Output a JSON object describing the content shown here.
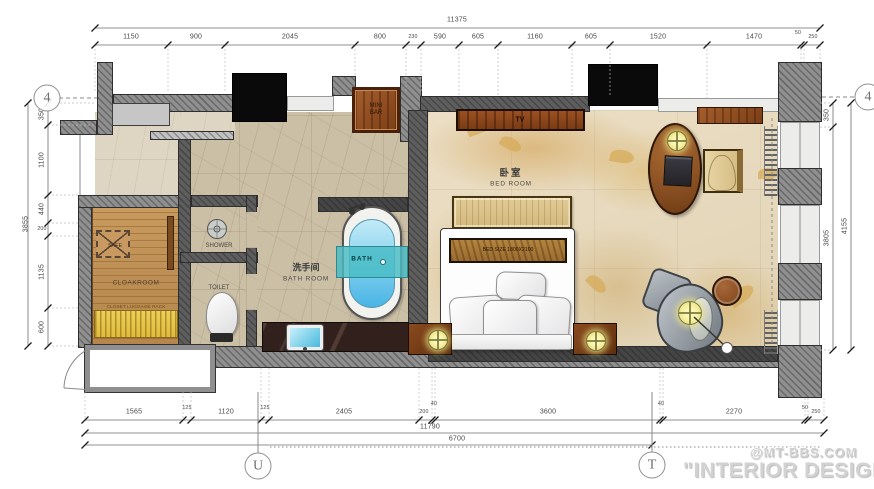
{
  "plan": {
    "markers": {
      "left": "4",
      "right": "4",
      "bottom_left": "U",
      "bottom_right": "T"
    },
    "rooms": {
      "bedroom_cn": "卧室",
      "bedroom_en": "BED ROOM",
      "bathroom_cn": "洗手间",
      "bathroom_en": "BATH ROOM",
      "cloakroom": "CLOAKROOM",
      "closet_rack": "CLOSET LUGGAGE RACK",
      "safe": "SAFE",
      "shower": "SHOWER",
      "toilet": "TOILET",
      "bath": "BATH",
      "minibar": "MINI BAR",
      "tv": "TV",
      "bed_size": "BED SIZE 1800X2100"
    }
  },
  "dims": {
    "top": {
      "total": "11375",
      "segments": [
        "1150",
        "900",
        "2045",
        "800",
        "230",
        "590",
        "605",
        "1160",
        "605",
        "1520",
        "1470",
        "50",
        "250"
      ]
    },
    "left": {
      "total": "3855",
      "segments": [
        "350",
        "1100",
        "440",
        "200",
        "1135",
        "600"
      ]
    },
    "right": {
      "inner": "350",
      "middle": "3805",
      "outer": "4155"
    },
    "bottom": {
      "segments": [
        "1565",
        "125",
        "1120",
        "125",
        "2405",
        "200",
        "40",
        "3600",
        "40",
        "2270",
        "50",
        "250"
      ],
      "span_full": "11790",
      "span_partial": "6700"
    }
  },
  "watermark": {
    "brand": "@MT-BBS.COM",
    "caption": "\"INTERIOR DESIGN"
  },
  "colors": {
    "wall": "#8f8f8f",
    "wood": "#8a4a1f",
    "water": "#54bfe8",
    "accent_teal": "#49bdc4",
    "lamp": "#f2eb96",
    "floor_bedroom": "#e8dcc3",
    "floor_bathroom": "#cbbfa6",
    "floor_cloak": "#c49257"
  }
}
